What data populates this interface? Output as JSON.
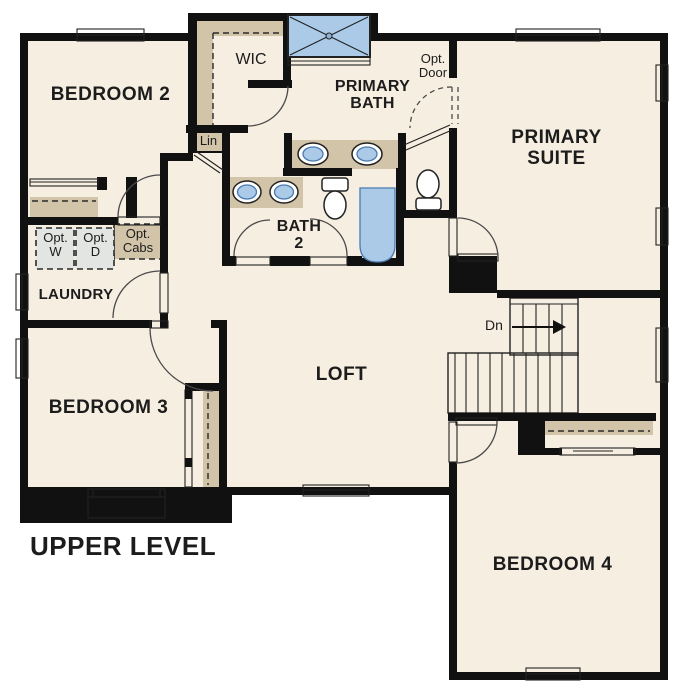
{
  "plan": {
    "title": "UPPER LEVEL"
  },
  "rooms": {
    "bedroom2": {
      "label": "BEDROOM 2"
    },
    "wic": {
      "label": "WIC"
    },
    "primary_bath": {
      "label": "PRIMARY BATH"
    },
    "primary_suite": {
      "label": "PRIMARY SUITE"
    },
    "bath2": {
      "label": "BATH 2"
    },
    "laundry": {
      "label": "LAUNDRY"
    },
    "loft": {
      "label": "LOFT"
    },
    "bedroom3": {
      "label": "BEDROOM 3"
    },
    "bedroom4": {
      "label": "BEDROOM 4"
    }
  },
  "annotations": {
    "linen": {
      "label": "Lin"
    },
    "opt_door": {
      "label": "Opt. Door"
    },
    "opt_washer": {
      "label": "Opt. W"
    },
    "opt_dryer": {
      "label": "Opt. D"
    },
    "opt_cabs": {
      "label": "Opt. Cabs"
    },
    "stairs_down": {
      "label": "Dn"
    }
  },
  "colors": {
    "floor": "#f6eee1",
    "counter_tan": "#d2c4a9",
    "fixture_blue": "#abcae8",
    "fixture_blue_dark": "#4a7ab0",
    "wall_black": "#111111",
    "appliance_gray": "#e3e5e2"
  }
}
